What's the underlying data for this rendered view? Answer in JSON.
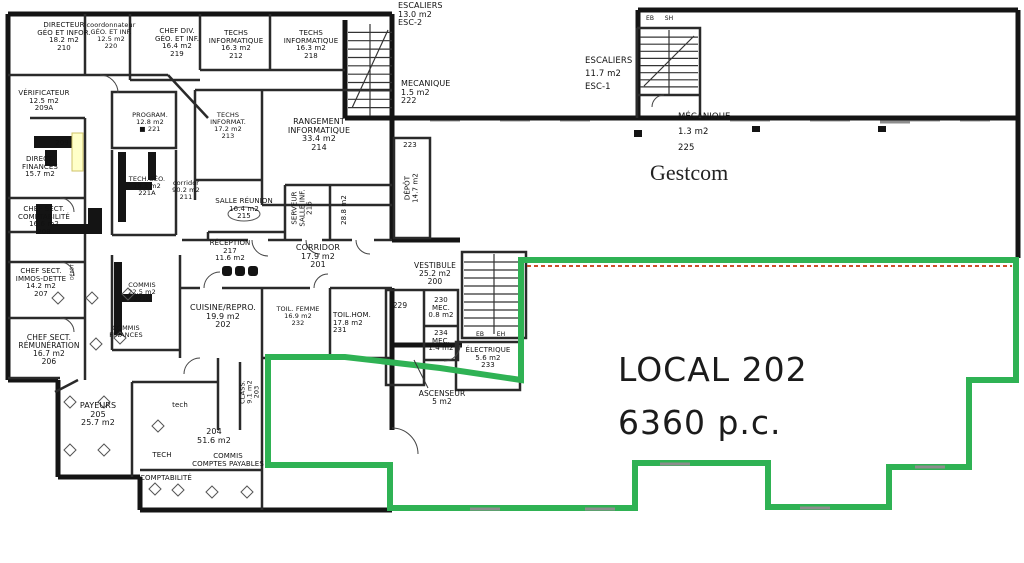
{
  "plan_title": {
    "local_label": "LOCAL 202",
    "local_area": "6360 p.c.",
    "tenant": "Gestcom"
  },
  "colors": {
    "wall": "#141414",
    "thin": "#2a2a2a",
    "window": "#9a9a9a",
    "outline_green": "#2fb254",
    "dashed_red": "#c9502a",
    "highlight_yellow": "#ffffc8",
    "highlight_border": "#cfc36a"
  },
  "labels": [
    {
      "name": "directeur-geo-infor",
      "lines": [
        "DIRECTEUR",
        "GÉO ET INFOR.",
        "18.2 m2",
        "210"
      ],
      "x": 64,
      "y": 22,
      "fs": 7
    },
    {
      "name": "coordonnateur-geo",
      "lines": [
        "coordonnateur",
        "GÉO. ET INF.",
        "12.5 m2",
        "220"
      ],
      "x": 111,
      "y": 22,
      "fs": 6.5
    },
    {
      "name": "chef-div-geo",
      "lines": [
        "CHEF DIV.",
        "GÉO. ET INF.",
        "16.4 m2",
        "219"
      ],
      "x": 177,
      "y": 28,
      "fs": 7
    },
    {
      "name": "techs-informatique-212",
      "lines": [
        "TECHS",
        "INFORMATIQUE",
        "16.3 m2",
        "212"
      ],
      "x": 236,
      "y": 30,
      "fs": 7
    },
    {
      "name": "techs-informatique-218",
      "lines": [
        "TECHS",
        "INFORMATIQUE",
        "16.3 m2",
        "218"
      ],
      "x": 311,
      "y": 30,
      "fs": 7
    },
    {
      "name": "escaliers-esc2",
      "lines": [
        "ESCALIERS",
        "13.0 m2",
        "ESC-2"
      ],
      "x": 398,
      "y": 2,
      "fs": 8,
      "align": "left"
    },
    {
      "name": "mecanique-222",
      "lines": [
        "MECANIQUE",
        "1.5 m2",
        "222"
      ],
      "x": 401,
      "y": 80,
      "fs": 8,
      "align": "left"
    },
    {
      "name": "escaliers-esc1",
      "lines": [
        "ESCALIERS",
        "11.7 m2",
        "ESC-1"
      ],
      "x": 585,
      "y": 55,
      "fs": 8.5,
      "align": "left",
      "lh": 1.5
    },
    {
      "name": "stair-label-eb-top",
      "lines": [
        "EB"
      ],
      "x": 650,
      "y": 16,
      "fs": 6
    },
    {
      "name": "stair-label-sh-top",
      "lines": [
        "SH"
      ],
      "x": 669,
      "y": 16,
      "fs": 6
    },
    {
      "name": "mecanique-225",
      "lines": [
        "MÉCANIQUE",
        "1.3 m2",
        "225"
      ],
      "x": 678,
      "y": 110,
      "fs": 8.5,
      "align": "left",
      "lh": 1.8
    },
    {
      "name": "verificateur",
      "lines": [
        "VÉRIFICATEUR",
        "12.5 m2",
        "209A"
      ],
      "x": 44,
      "y": 90,
      "fs": 7
    },
    {
      "name": "room-209",
      "lines": [
        "209"
      ],
      "x": 62,
      "y": 140,
      "fs": 7
    },
    {
      "name": "directeur-finances",
      "lines": [
        "DIRECT.",
        "FINANCES",
        "15.7 m2"
      ],
      "x": 40,
      "y": 156,
      "fs": 7
    },
    {
      "name": "chef-sect-comptabilite",
      "lines": [
        "CHEF SECT.",
        "COMPTABILITÉ",
        "16.6 m2",
        "208"
      ],
      "x": 44,
      "y": 206,
      "fs": 7
    },
    {
      "name": "chef-sect-immos-dette",
      "lines": [
        "CHEF SECT.",
        "IMMOS-DETTE",
        "14.2 m2",
        "207"
      ],
      "x": 41,
      "y": 268,
      "fs": 7
    },
    {
      "name": "depot-mini",
      "lines": [
        "DÉPÔT"
      ],
      "x": 74,
      "y": 272,
      "fs": 4.5,
      "rot": true
    },
    {
      "name": "chef-sect-remuneration",
      "lines": [
        "CHEF SECT.",
        "RÉMUNÉRATION",
        "16.7 m2",
        "206"
      ],
      "x": 49,
      "y": 334,
      "fs": 7.5
    },
    {
      "name": "payeurs-205",
      "lines": [
        "PAYEURS",
        "205",
        "25.7 m2"
      ],
      "x": 98,
      "y": 402,
      "fs": 8
    },
    {
      "name": "tech-small",
      "lines": [
        "tech"
      ],
      "x": 180,
      "y": 402,
      "fs": 7
    },
    {
      "name": "tech-caps",
      "lines": [
        "TECH"
      ],
      "x": 162,
      "y": 452,
      "fs": 7
    },
    {
      "name": "comptabilite",
      "lines": [
        "COMPTABILITÉ"
      ],
      "x": 166,
      "y": 475,
      "fs": 7
    },
    {
      "name": "room-204",
      "lines": [
        "204",
        "51.6 m2"
      ],
      "x": 214,
      "y": 428,
      "fs": 8
    },
    {
      "name": "commis-comptes-payables",
      "lines": [
        "COMMIS",
        "COMPTES PAYABLES"
      ],
      "x": 228,
      "y": 453,
      "fs": 7
    },
    {
      "name": "program-221",
      "lines": [
        "PROGRAM.",
        "12.8 m2",
        "■  221"
      ],
      "x": 150,
      "y": 112,
      "fs": 6.5
    },
    {
      "name": "tech-geo-221a",
      "lines": [
        "TECH.GÉO.",
        "19.3 m2",
        "221A"
      ],
      "x": 147,
      "y": 176,
      "fs": 6.5
    },
    {
      "name": "corridor-211",
      "lines": [
        "corridor",
        "90.2 m2",
        "211"
      ],
      "x": 186,
      "y": 180,
      "fs": 6.5
    },
    {
      "name": "commis-221b",
      "lines": [
        "COMMIS",
        "22.5 m2",
        "221B"
      ],
      "x": 142,
      "y": 282,
      "fs": 6.5
    },
    {
      "name": "commis-finances",
      "lines": [
        "COMMIS",
        "FINANCES"
      ],
      "x": 126,
      "y": 325,
      "fs": 6.5
    },
    {
      "name": "techs-informat-213",
      "lines": [
        "TECHS",
        "INFORMAT.",
        "17.2 m2",
        "213"
      ],
      "x": 228,
      "y": 112,
      "fs": 6.5
    },
    {
      "name": "rangement-informatique-214",
      "lines": [
        "RANGEMENT",
        "INFORMATIQUE",
        "33.4 m2",
        "214"
      ],
      "x": 319,
      "y": 118,
      "fs": 8
    },
    {
      "name": "salle-reunion-215",
      "lines": [
        "SALLE RÉUNION",
        "16.4 m2",
        "215"
      ],
      "x": 244,
      "y": 198,
      "fs": 7
    },
    {
      "name": "serveur-salle-inf-216",
      "lines": [
        "SERVEUR",
        "SALLE INF.",
        "216"
      ],
      "x": 303,
      "y": 208,
      "fs": 7,
      "rot": true
    },
    {
      "name": "room-28-8",
      "lines": [
        "28.8 m2"
      ],
      "x": 345,
      "y": 210,
      "fs": 7,
      "rot": true
    },
    {
      "name": "room-223",
      "lines": [
        "223"
      ],
      "x": 410,
      "y": 142,
      "fs": 7
    },
    {
      "name": "depot-223",
      "lines": [
        "DÉPÔT",
        "14.7 m2"
      ],
      "x": 412,
      "y": 188,
      "fs": 7,
      "rot": true
    },
    {
      "name": "reception-217",
      "lines": [
        "RÉCEPTION",
        "217",
        "11.6 m2"
      ],
      "x": 230,
      "y": 240,
      "fs": 7
    },
    {
      "name": "corridor-201",
      "lines": [
        "CORRIDOR",
        "17.9 m2",
        "201"
      ],
      "x": 318,
      "y": 244,
      "fs": 8
    },
    {
      "name": "vestibule-200",
      "lines": [
        "VESTIBULE",
        "25.2 m2",
        "200"
      ],
      "x": 435,
      "y": 262,
      "fs": 7.5
    },
    {
      "name": "cuisine-repro-202",
      "lines": [
        "CUISINE/REPRO.",
        "19.9 m2",
        "202"
      ],
      "x": 223,
      "y": 304,
      "fs": 8
    },
    {
      "name": "toil-femme-232",
      "lines": [
        "TOIL. FEMME",
        "16.9 m2",
        "232"
      ],
      "x": 298,
      "y": 306,
      "fs": 6.5
    },
    {
      "name": "toil-hom-231",
      "lines": [
        "TOIL.HOM.",
        "17.8 m2",
        "231"
      ],
      "x": 333,
      "y": 312,
      "fs": 7,
      "align": "left"
    },
    {
      "name": "room-229",
      "lines": [
        "229"
      ],
      "x": 400,
      "y": 302,
      "fs": 7.5
    },
    {
      "name": "mec-230",
      "lines": [
        "230",
        "MEC.",
        "0.8 m2"
      ],
      "x": 441,
      "y": 297,
      "fs": 7
    },
    {
      "name": "mec-234",
      "lines": [
        "234",
        "MEC.",
        "1.4 m2"
      ],
      "x": 441,
      "y": 330,
      "fs": 7
    },
    {
      "name": "stair-label-eb-vestibule",
      "lines": [
        "EB"
      ],
      "x": 480,
      "y": 332,
      "fs": 6
    },
    {
      "name": "stair-label-eh-vestibule",
      "lines": [
        "EH"
      ],
      "x": 501,
      "y": 332,
      "fs": 6
    },
    {
      "name": "electrique-233",
      "lines": [
        "ÉLECTRIQUE",
        "5.6 m2",
        "233"
      ],
      "x": 488,
      "y": 347,
      "fs": 7
    },
    {
      "name": "ascenseur",
      "lines": [
        "ASCENSEUR",
        "5 m2"
      ],
      "x": 442,
      "y": 390,
      "fs": 7.5
    },
    {
      "name": "class-203",
      "lines": [
        "CLASS.",
        "9.1 m2",
        "203"
      ],
      "x": 250,
      "y": 392,
      "fs": 6.5,
      "rot": true
    }
  ]
}
